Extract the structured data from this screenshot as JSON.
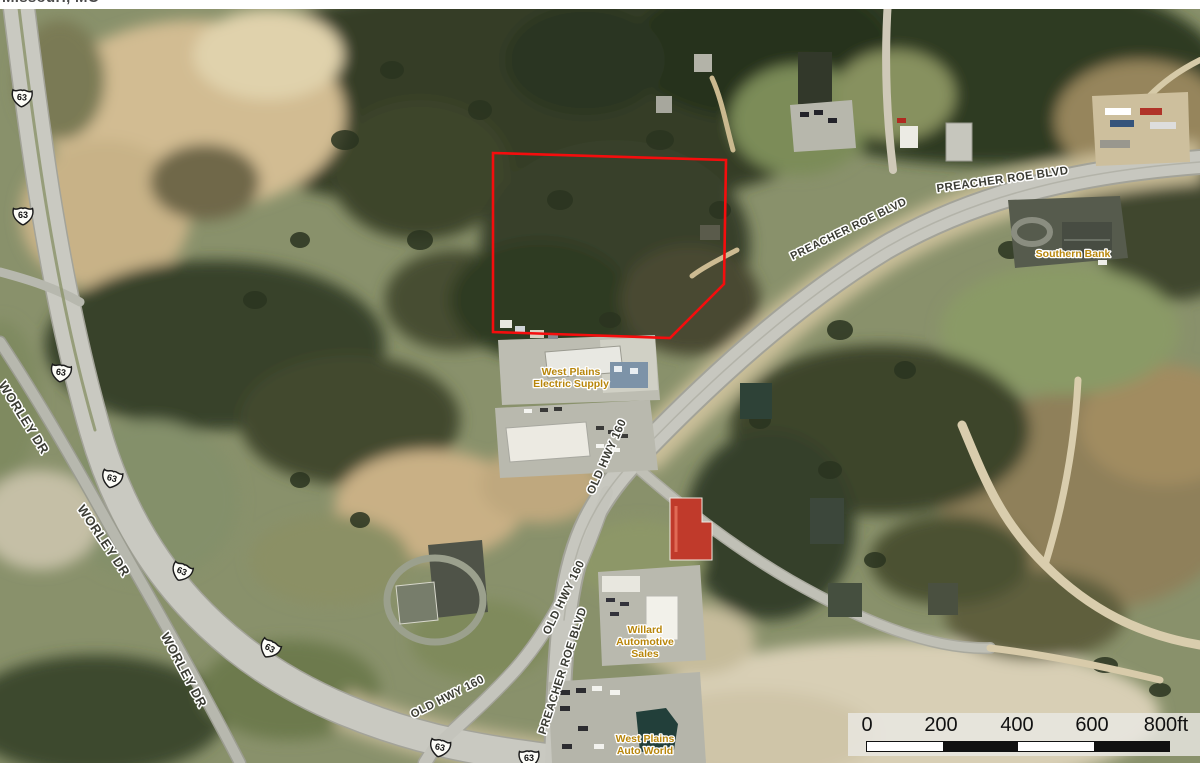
{
  "header": {
    "location_text": "Missouri, MO"
  },
  "colors": {
    "road_label": "#3b3c34",
    "business_label": "#b8860b",
    "label_halo": "#ffffff",
    "parcel_outline": "#f50d0d"
  },
  "map": {
    "parcel": {
      "points": "493,153 726,160 724,284 670,338 493,332",
      "color": "#f50d0d"
    },
    "road_labels": [
      {
        "text": "PREACHER ROE BLVD",
        "x": 850,
        "y": 232,
        "rot": -26,
        "size": 11
      },
      {
        "text": "PREACHER ROE BLVD",
        "x": 1003,
        "y": 183,
        "rot": -8,
        "size": 11.5
      },
      {
        "text": "PREACHER ROE BLVD",
        "x": 566,
        "y": 672,
        "rot": -72,
        "size": 11.5
      },
      {
        "text": "OLD HWY 160",
        "x": 610,
        "y": 458,
        "rot": -66,
        "size": 11.5
      },
      {
        "text": "OLD HWY 160",
        "x": 567,
        "y": 599,
        "rot": -64,
        "size": 11.5
      },
      {
        "text": "OLD HWY 160",
        "x": 449,
        "y": 700,
        "rot": -27,
        "size": 11.5
      },
      {
        "text": "WORLEY DR",
        "x": 20,
        "y": 420,
        "rot": 58,
        "size": 13
      },
      {
        "text": "WORLEY DR",
        "x": 100,
        "y": 543,
        "rot": 56,
        "size": 13
      },
      {
        "text": "WORLEY DR",
        "x": 180,
        "y": 672,
        "rot": 62,
        "size": 13
      }
    ],
    "business_labels": [
      {
        "name": "west-plains-electric-supply",
        "lines": [
          "West Plains",
          "Electric Supply"
        ],
        "x": 571,
        "y": 375
      },
      {
        "name": "southern-bank",
        "lines": [
          "Southern Bank"
        ],
        "x": 1073,
        "y": 257
      },
      {
        "name": "willard-automotive-sales",
        "lines": [
          "Willard",
          "Automotive",
          "Sales"
        ],
        "x": 645,
        "y": 633
      },
      {
        "name": "west-plains-auto-world",
        "lines": [
          "West Plains",
          "Auto World"
        ],
        "x": 645,
        "y": 742
      }
    ],
    "highway_shields": [
      {
        "route": "63",
        "x": 22,
        "y": 97,
        "rot": 4
      },
      {
        "route": "63",
        "x": 23,
        "y": 215,
        "rot": 0
      },
      {
        "route": "63",
        "x": 61,
        "y": 372,
        "rot": 8
      },
      {
        "route": "63",
        "x": 112,
        "y": 478,
        "rot": 14
      },
      {
        "route": "63",
        "x": 182,
        "y": 571,
        "rot": 22
      },
      {
        "route": "63",
        "x": 270,
        "y": 648,
        "rot": 28
      },
      {
        "route": "63",
        "x": 440,
        "y": 747,
        "rot": 12
      },
      {
        "route": "63",
        "x": 529,
        "y": 758,
        "rot": 0
      }
    ],
    "scale_bar": {
      "labels": [
        "0",
        "200",
        "400",
        "600",
        "800ft"
      ],
      "segment_colors": [
        "#ffffff",
        "#111111",
        "#ffffff",
        "#111111"
      ]
    }
  }
}
